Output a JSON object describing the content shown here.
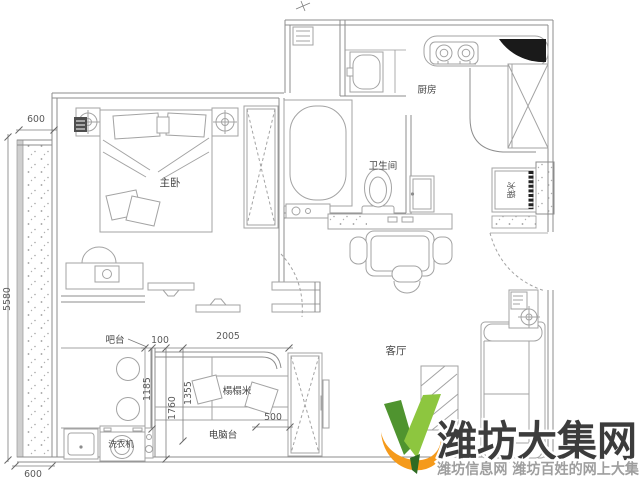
{
  "canvas": {
    "width": 640,
    "height": 489,
    "background": "#ffffff"
  },
  "floorplan": {
    "wall_color": "#8c8c8c",
    "furniture_color": "#a3a3a3",
    "label_color": "#454545",
    "rooms": [
      {
        "id": "master-bedroom",
        "label": "主卧"
      },
      {
        "id": "bathroom",
        "label": "卫生间"
      },
      {
        "id": "kitchen",
        "label": "厨房"
      },
      {
        "id": "living-room",
        "label": "客厅"
      },
      {
        "id": "tatami-room",
        "label": "榻榻米"
      }
    ],
    "fixtures": [
      {
        "id": "bar-counter",
        "label": "吧台"
      },
      {
        "id": "washing-machine",
        "label": "洗衣机"
      },
      {
        "id": "computer-desk",
        "label": "电脑台"
      },
      {
        "id": "fridge",
        "label": "冰箱"
      }
    ],
    "dimensions": [
      {
        "id": "balcony-width-top",
        "value": "600"
      },
      {
        "id": "left-side-height",
        "value": "5580"
      },
      {
        "id": "balcony-width-bottom",
        "value": "600"
      },
      {
        "id": "wall-gap",
        "value": "100"
      },
      {
        "id": "tatami-room-width",
        "value": "2005"
      },
      {
        "id": "bar-counter-length",
        "value": "1185"
      },
      {
        "id": "tatami-room-height",
        "value": "1760"
      },
      {
        "id": "tatami-bed-width",
        "value": "1355"
      },
      {
        "id": "cabinet-width",
        "value": "500"
      }
    ]
  },
  "watermark": {
    "brand": "潍坊大集网",
    "tagline": "潍坊信息网 潍坊百姓的网上大集",
    "brand_color": "#3c3c3c",
    "tagline_color": "#9e9e9e",
    "logo": {
      "green_dark": "#4f942f",
      "green_light": "#8dc63f",
      "orange": "#f59a1b"
    }
  }
}
